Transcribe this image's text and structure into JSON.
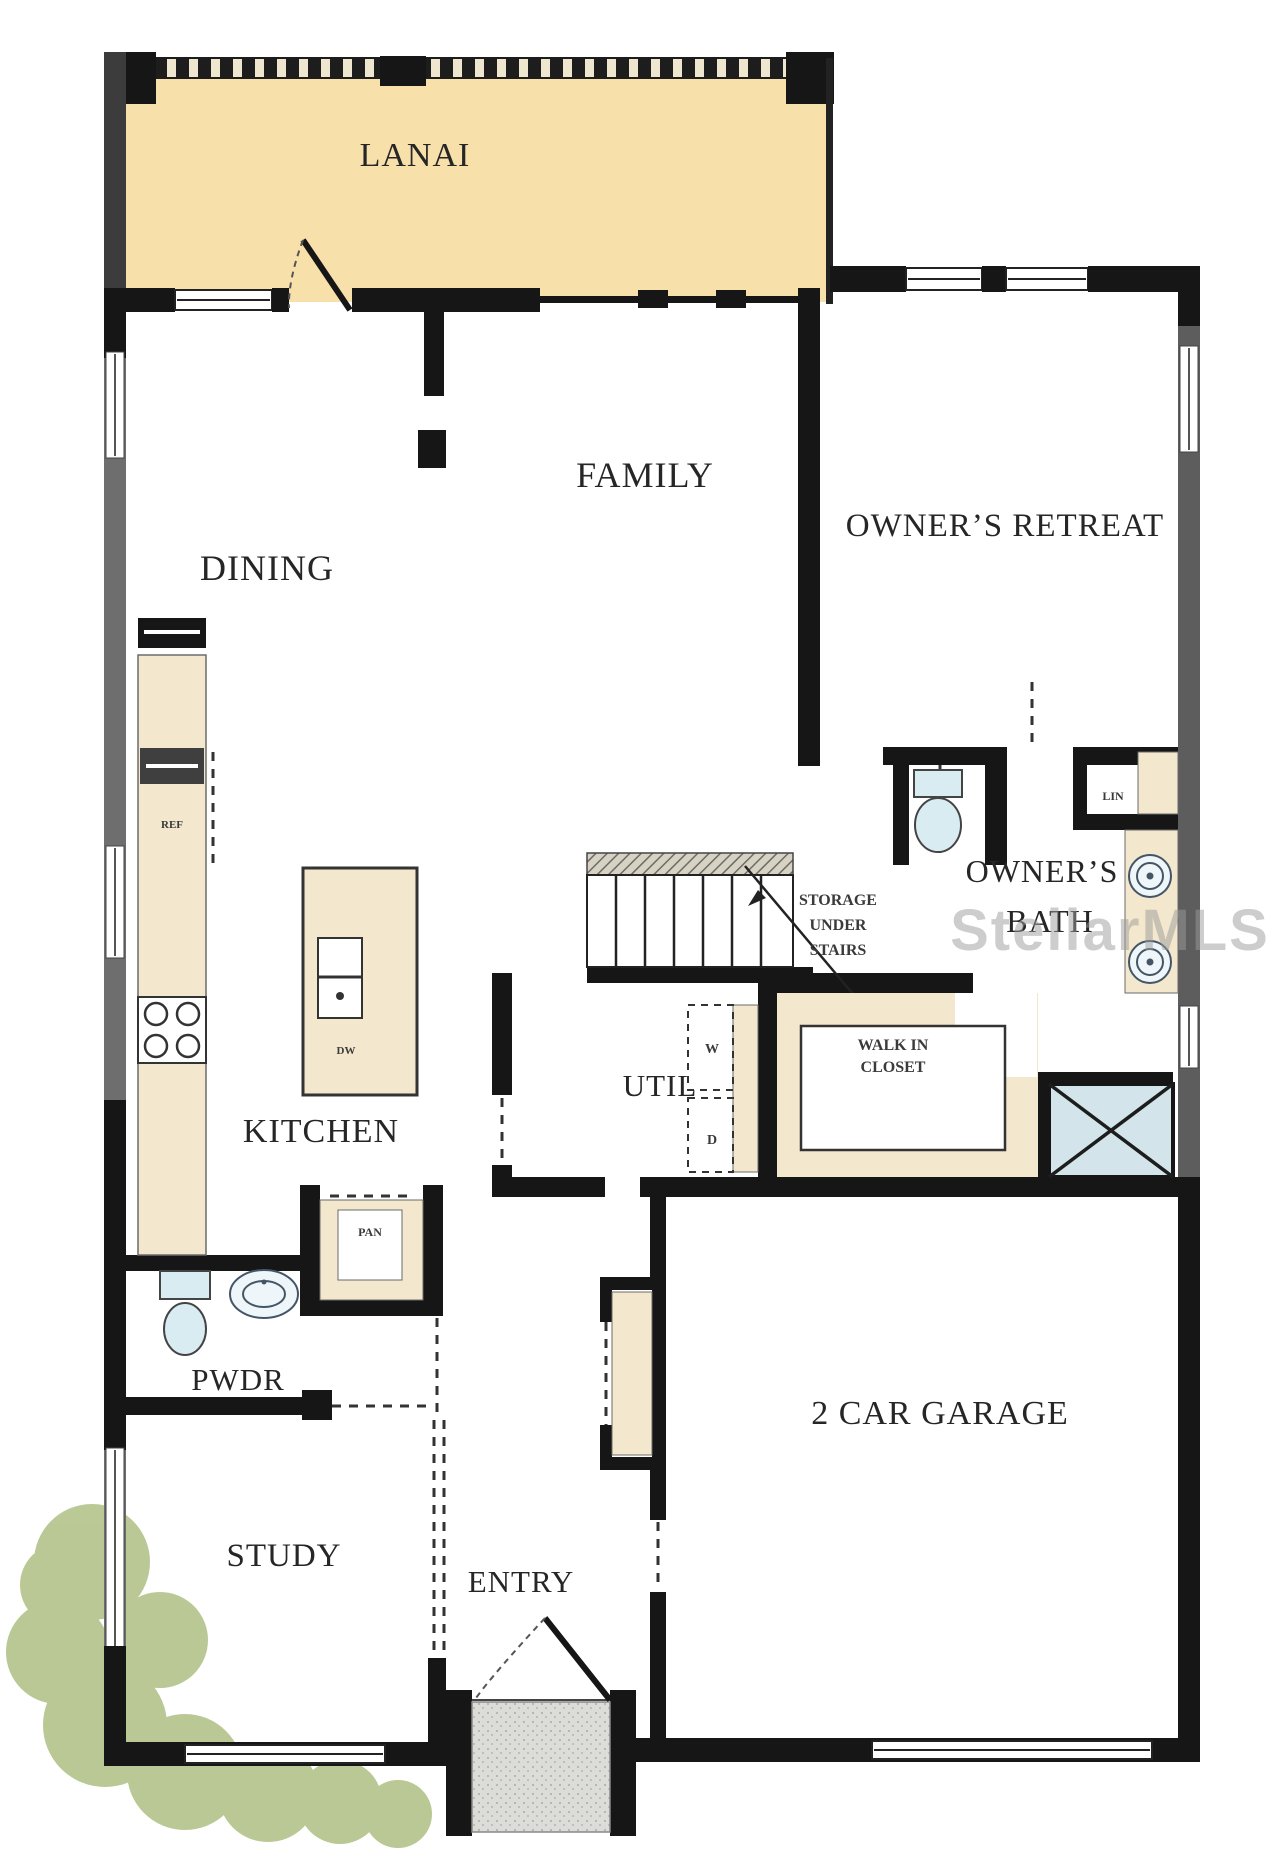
{
  "plan": {
    "watermark": "StellarMLS",
    "rooms": {
      "lanai": "LANAI",
      "family": "FAMILY",
      "dining": "DINING",
      "owners_retreat": "OWNER’S RETREAT",
      "owners_bath_line1": "OWNER’S",
      "owners_bath_line2": "BATH",
      "kitchen": "KITCHEN",
      "util": "UTIL",
      "storage_line1": "STORAGE",
      "storage_line2": "UNDER",
      "storage_line3": "STAIRS",
      "walkin_line1": "WALK IN",
      "walkin_line2": "CLOSET",
      "pwdr": "PWDR",
      "study": "STUDY",
      "entry": "ENTRY",
      "garage": "2 CAR GARAGE",
      "pantry": "PAN",
      "linen": "LIN",
      "washer": "W",
      "dryer": "D",
      "fridge": "REF",
      "dishwasher": "DW"
    },
    "colors": {
      "lanai_floor": "#f7e0aa",
      "counter_tan": "#f3e7cd",
      "shower_blue": "#d3e4ea",
      "fixture_blue": "#d8ecf2",
      "porch_grey": "#dbdbd8",
      "bush_green": "#b6c690",
      "wall_black": "#161616",
      "wall_grey": "#666666",
      "watermark_grey": "#9c9c9c"
    }
  }
}
